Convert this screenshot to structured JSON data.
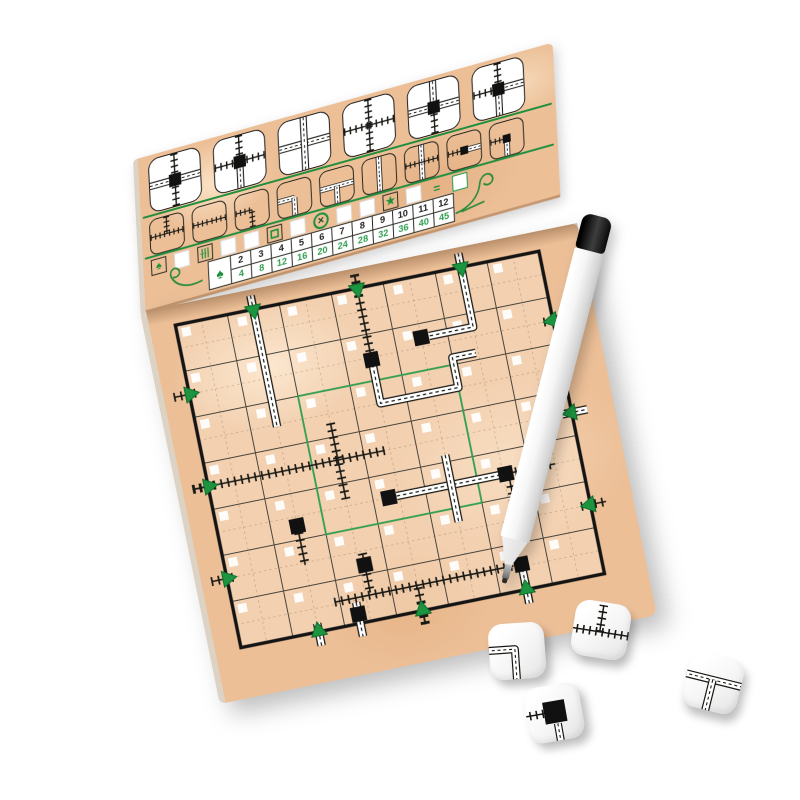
{
  "colors": {
    "paper_tan": "#ecbf97",
    "ink_black": "#191914",
    "accent_green": "#1f8f3e",
    "score_green": "#2f9e4f",
    "station_black": "#111111",
    "road_white": "#ffffff"
  },
  "flap": {
    "special_tiles": [
      {
        "l": "road",
        "r": "road",
        "u": "rail",
        "d": "rail",
        "c": "station"
      },
      {
        "l": "rail",
        "r": "rail",
        "u": "rail",
        "d": "road",
        "c": "station"
      },
      {
        "l": "road",
        "r": "road",
        "u": "road",
        "d": "road",
        "c": "none"
      },
      {
        "l": "rail",
        "r": "rail",
        "u": "rail",
        "d": "rail",
        "c": "none"
      },
      {
        "l": "road",
        "r": "road",
        "u": "road",
        "d": "rail",
        "c": "station"
      },
      {
        "l": "rail",
        "r": "road",
        "u": "rail",
        "d": "road",
        "c": "station"
      }
    ],
    "dice_legend_tiles": [
      {
        "name": "rail-t",
        "l": "rail",
        "r": "rail",
        "u": "rail"
      },
      {
        "name": "rail-straight",
        "l": "rail",
        "r": "rail"
      },
      {
        "name": "rail-curve",
        "l": "rail",
        "d": "rail"
      },
      {
        "name": "road-curve",
        "l": "road",
        "d": "road"
      },
      {
        "name": "road-t",
        "l": "road",
        "r": "road",
        "d": "road"
      },
      {
        "name": "road-straight",
        "u": "road",
        "d": "road"
      },
      {
        "name": "overpass",
        "l": "rail",
        "r": "rail",
        "u": "road",
        "d": "road"
      },
      {
        "name": "station-straight",
        "l": "rail",
        "r": "road",
        "c": "station"
      },
      {
        "name": "station-curve",
        "l": "rail",
        "d": "road",
        "c": "station"
      }
    ],
    "tracker_row": [
      {
        "type": "glyph-box",
        "glyph": "tree"
      },
      {
        "type": "checkbox"
      },
      {
        "type": "glyph-box",
        "glyph": "rails"
      },
      {
        "type": "checkbox"
      },
      {
        "type": "checkbox"
      },
      {
        "type": "glyph-box",
        "glyph": "square"
      },
      {
        "type": "checkbox"
      },
      {
        "type": "circle-x",
        "glyph": "x"
      },
      {
        "type": "checkbox"
      },
      {
        "type": "checkbox"
      },
      {
        "type": "glyph-box",
        "glyph": "star"
      },
      {
        "type": "checkbox"
      },
      {
        "type": "text",
        "value": "="
      },
      {
        "type": "green-box"
      }
    ],
    "score_table": {
      "header_icon": "tree",
      "exits_row": [
        "2",
        "3",
        "4",
        "5",
        "6",
        "7",
        "8",
        "9",
        "10",
        "11",
        "12"
      ],
      "points_row": [
        "4",
        "8",
        "12",
        "16",
        "20",
        "24",
        "28",
        "32",
        "36",
        "40",
        "45"
      ]
    }
  },
  "board": {
    "grid": {
      "cols": 7,
      "rows": 7
    },
    "center_square": {
      "x1": 2,
      "y1": 2,
      "x2": 5,
      "y2": 5
    },
    "exits": [
      {
        "side": "N",
        "pos": 1.5,
        "kind": "road"
      },
      {
        "side": "N",
        "pos": 3.5,
        "kind": "rail"
      },
      {
        "side": "N",
        "pos": 5.5,
        "kind": "road"
      },
      {
        "side": "S",
        "pos": 1.5,
        "kind": "road"
      },
      {
        "side": "S",
        "pos": 3.5,
        "kind": "rail"
      },
      {
        "side": "S",
        "pos": 5.5,
        "kind": "road"
      },
      {
        "side": "W",
        "pos": 1.5,
        "kind": "rail"
      },
      {
        "side": "W",
        "pos": 3.5,
        "kind": "rail"
      },
      {
        "side": "W",
        "pos": 5.5,
        "kind": "rail"
      },
      {
        "side": "E",
        "pos": 1.5,
        "kind": "rail"
      },
      {
        "side": "E",
        "pos": 3.5,
        "kind": "road"
      },
      {
        "side": "E",
        "pos": 5.5,
        "kind": "rail"
      }
    ],
    "rails": [
      [
        [
          3.5,
          -0.28
        ],
        [
          3.5,
          1.5
        ]
      ],
      [
        [
          -0.28,
          3.5
        ],
        [
          3.4,
          3.5
        ]
      ],
      [
        [
          2.5,
          2.7
        ],
        [
          2.5,
          4.35
        ]
      ],
      [
        [
          5.6,
          4.5
        ],
        [
          6.5,
          4.5
        ]
      ],
      [
        [
          5.6,
          4.62
        ],
        [
          5.6,
          5.35
        ]
      ],
      [
        [
          1.9,
          6.45
        ],
        [
          5.35,
          6.45
        ]
      ],
      [
        [
          1.5,
          4.85
        ],
        [
          1.5,
          5.55
        ]
      ],
      [
        [
          2.6,
          5.55
        ],
        [
          2.6,
          6.4
        ]
      ],
      [
        [
          3.5,
          6.5
        ],
        [
          3.5,
          7.28
        ]
      ]
    ],
    "roads": [
      [
        [
          1.5,
          -0.28
        ],
        [
          1.5,
          2.55
        ]
      ],
      [
        [
          5.5,
          -0.28
        ],
        [
          5.5,
          1.3
        ],
        [
          4.65,
          1.3
        ]
      ],
      [
        [
          3.5,
          1.65
        ],
        [
          3.5,
          2.5
        ],
        [
          5.0,
          2.5
        ],
        [
          5.0,
          1.85
        ],
        [
          5.45,
          1.85
        ]
      ],
      [
        [
          3.45,
          4.5
        ],
        [
          5.45,
          4.5
        ]
      ],
      [
        [
          4.5,
          3.85
        ],
        [
          4.5,
          5.3
        ]
      ],
      [
        [
          2.3,
          6.55
        ],
        [
          2.3,
          7.28
        ]
      ],
      [
        [
          5.5,
          6.55
        ],
        [
          5.5,
          7.28
        ]
      ]
    ],
    "stations": [
      [
        3.5,
        1.55
      ],
      [
        4.5,
        1.3
      ],
      [
        5.55,
        4.5
      ],
      [
        3.3,
        4.5
      ],
      [
        1.5,
        4.7
      ],
      [
        2.6,
        5.8
      ],
      [
        2.3,
        6.8
      ],
      [
        5.5,
        6.45
      ]
    ]
  },
  "dice": [
    {
      "face": "road-curve",
      "x": 489,
      "y": 623,
      "rot": -4
    },
    {
      "face": "rail-t",
      "x": 573,
      "y": 602,
      "rot": 9
    },
    {
      "face": "station",
      "x": 526,
      "y": 685,
      "rot": -10
    },
    {
      "face": "road-t",
      "x": 685,
      "y": 655,
      "rot": 14
    }
  ],
  "pen": {
    "kind": "dry-erase-marker"
  }
}
